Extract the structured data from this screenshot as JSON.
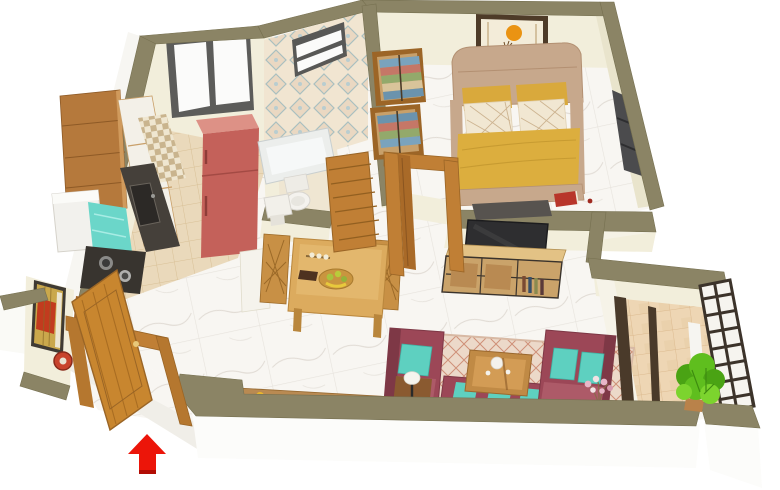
{
  "meta": {
    "kind": "3d-isometric-floor-plan-render",
    "view": "cutaway top-down isometric",
    "description": "Furnished apartment 3D floor plan: kitchen, bathroom, bedroom, dining, living room, balcony, entrance with red entry arrow"
  },
  "palette": {
    "wall_top": "#8b8465",
    "wall_top_edge": "#767050",
    "wall_face": "#f2eedb",
    "wall_face_shade": "#e9e4cc",
    "outer_face": "#fcfcfa",
    "slab_face": "#f0eee8",
    "marble": "#f8f6f2",
    "marble_vein": "#d9d3cc",
    "kitchen_tile": "#ead9bb",
    "kitchen_tile_line": "#d8c096",
    "balcony_tile": "#eed6b4",
    "balcony_tile_line": "#dcba8f",
    "bath_tile_bg": "#f1e5d1",
    "bath_tile_motif": "#a9bfc0",
    "bath_floor": "#efe6d2",
    "checker_dark": "#c9b48e",
    "wood": "#b5793c",
    "wood_light": "#d9a85c",
    "wood_table": "#dcab5e",
    "door_wood": "#c8862f",
    "door_wood_dark": "#9a6526",
    "frame_wood": "#c07f35",
    "granite": "#45403a",
    "sink_dark": "#2c2926",
    "stove_dark": "#38342f",
    "fridge_red": "#c4615a",
    "fridge_red_top": "#dd9186",
    "washer_white": "#f2f1ed",
    "towel_teal": "#6bd6c9",
    "headboard_tan": "#c7a88c",
    "bed_yellow": "#dcae3e",
    "pillow_yellow": "#d9a93c",
    "pillow_cream": "#f1e7d2",
    "pillow_lattice": "#cdb491",
    "rug_dark": "#57534f",
    "book_red": "#b8352a",
    "art_frame": "#4e3b28",
    "art_cream": "#f3ecd9",
    "art_sun_orange": "#ea9312",
    "deer_brown": "#6e4a23",
    "shelf_dark": "#4b4b4d",
    "tv_black": "#2e2e30",
    "console_wood": "#caa36a",
    "console_top": "#e3c285",
    "metal_frame": "#3a332c",
    "sofa_maroon": "#9c4757",
    "sofa_maroon_dark": "#7e3846",
    "sofa_maroon_light": "#ad5a68",
    "cushion_teal": "#5ed0c0",
    "cushion_teal_edge": "#3fb3a4",
    "rug_beige": "#ecd9c9",
    "rug_line": "#cf9078",
    "lamp_shade": "#f6f4ee",
    "lamp_dark": "#2a2a2a",
    "flower_pink": "#e8b6c8",
    "plant_green": "#5fbe1e",
    "plant_green_dark": "#4aa314",
    "plant_green_light": "#7cd42e",
    "railing_dark": "#3c332a",
    "window_frame": "#5c5c5a",
    "window_pane": "#fbfbfa",
    "entry_art_red": "#c23b1e",
    "entry_art_gold": "#caa84c",
    "clock_red": "#c8432c",
    "arrow_red": "#ec1509",
    "tub_white": "#eceeec",
    "porcelain": "#f4f2ee"
  },
  "rooms": [
    {
      "id": "kitchen",
      "furniture": [
        "wall-cabinet",
        "white-cabinets",
        "granite-counter",
        "sink",
        "gas-stove",
        "refrigerator",
        "washing-machine",
        "teal-towel",
        "checker-backsplash",
        "sliding-window"
      ]
    },
    {
      "id": "bathroom",
      "furniture": [
        "patterned-tile-wall",
        "ventilator-window",
        "bathtub",
        "toilet",
        "wash-basin",
        "louvered-door"
      ]
    },
    {
      "id": "bedroom",
      "furniture": [
        "double-bed",
        "yellow-duvet",
        "wardrobe-clothes-shelves",
        "deer-wall-art",
        "wall-shelf",
        "foot-rug",
        "red-book",
        "door-frame"
      ]
    },
    {
      "id": "dining",
      "furniture": [
        "dining-table",
        "carved-chair-left",
        "carved-chair-right",
        "fruit-platter",
        "chocolate-bar",
        "candle-tray"
      ]
    },
    {
      "id": "living",
      "furniture": [
        "tv",
        "tv-console",
        "armchair",
        "two-seat-sofa",
        "bench-sofa",
        "coffee-table",
        "tea-set",
        "area-rug",
        "side-table-lamp",
        "flower-bunch",
        "console-ledge"
      ]
    },
    {
      "id": "balcony",
      "furniture": [
        "potted-plant",
        "lattice-railing",
        "terracotta-tiles",
        "balcony-door-frame"
      ]
    },
    {
      "id": "entrance",
      "furniture": [
        "main-door-open",
        "door-frame",
        "abstract-wall-art",
        "wall-clock",
        "shoe-box",
        "entry-arrow"
      ]
    }
  ],
  "indicators": {
    "entry_arrow": {
      "shape": "arrow-up",
      "color": "#ec1509"
    }
  }
}
